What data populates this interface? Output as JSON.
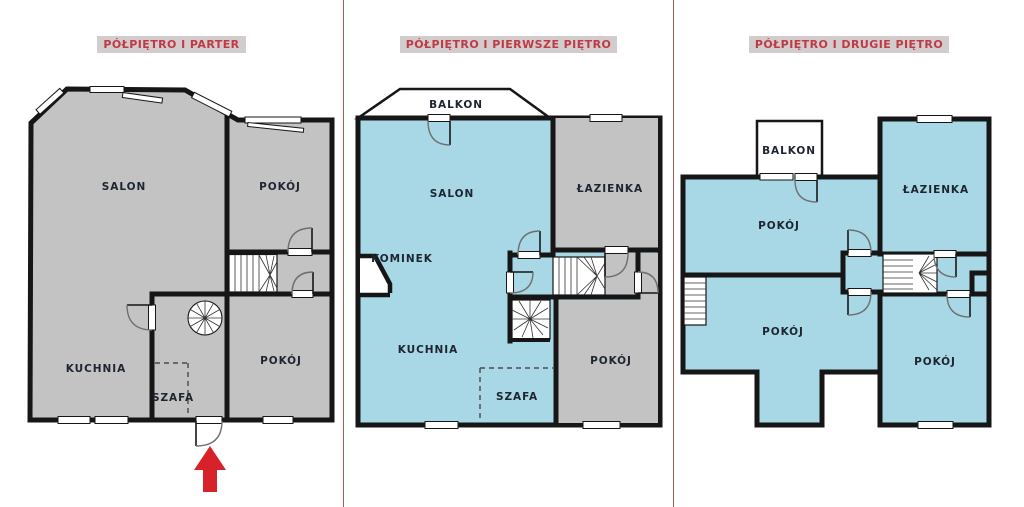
{
  "document": {
    "type": "floor-plan-set",
    "language": "pl"
  },
  "colors": {
    "unit_fill_blue": "#a8d8e6",
    "other_fill_gray": "#c3c3c3",
    "wall": "#161616",
    "title_text": "#bf3a45",
    "title_background": "#d2cccc",
    "separator": "#aa5b5b",
    "entrance_arrow": "#d7222a",
    "background": "#ffffff"
  },
  "panels": [
    {
      "title": "PÓŁPIĘTRO I PARTER",
      "rooms": {
        "salon": "SALON",
        "pokoj_gorny": "POKÓJ",
        "kuchnia": "KUCHNIA",
        "szafa": "SZAFA",
        "pokoj_dolny": "POKÓJ"
      },
      "features": [
        "spiral-staircase",
        "winder-staircase",
        "entrance-arrow"
      ]
    },
    {
      "title": "PÓŁPIĘTRO I PIERWSZE PIĘTRO",
      "rooms": {
        "balkon": "BALKON",
        "salon": "SALON",
        "lazienka": "ŁAZIENKA",
        "kominek": "KOMINEK",
        "kuchnia": "KUCHNIA",
        "szafa": "SZAFA",
        "pokoj": "POKÓJ"
      },
      "features": [
        "spiral-staircase",
        "winder-staircase",
        "fireplace"
      ]
    },
    {
      "title": "PÓŁPIĘTRO I DRUGIE PIĘTRO",
      "rooms": {
        "balkon": "BALKON",
        "lazienka": "ŁAZIENKA",
        "pokoj_gorny": "POKÓJ",
        "pokoj_srodkowy": "POKÓJ",
        "pokoj_prawy": "POKÓJ"
      },
      "features": [
        "winder-staircase",
        "half-landing-stairs"
      ]
    }
  ]
}
